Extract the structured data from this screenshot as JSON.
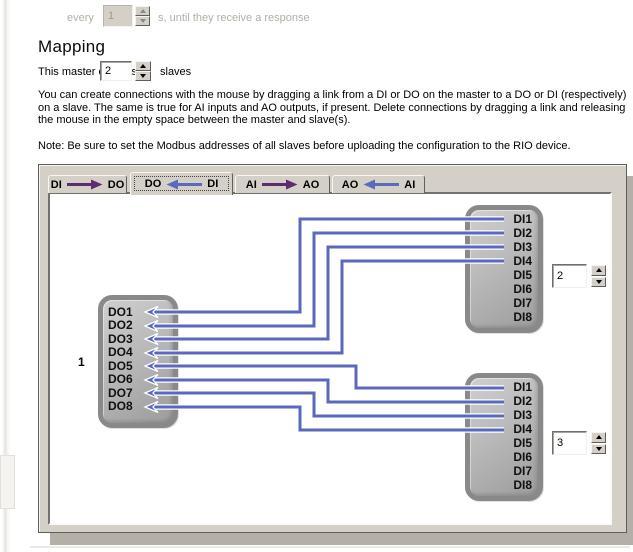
{
  "top_row": {
    "prefix": "every",
    "spin_value": "1",
    "suffix": "s, until they receive a response"
  },
  "heading": "Mapping",
  "master_controls": {
    "prefix": "This master controls",
    "spin_value": "2",
    "suffix": "slaves"
  },
  "paragraph": "You can create connections with the mouse by dragging a link from a DI or DO on the master to a DO or DI (respectively)\non a slave. The same is true for AI inputs and AO outputs, if present. Delete connections by dragging a link and releasing\nthe mouse in the empty space between the master and slave(s).",
  "note": "Note: Be sure to set the Modbus addresses of all slaves before uploading the configuration to the RIO device.",
  "tabs": [
    {
      "left": "DI",
      "right": "DO",
      "direction": "right",
      "arrow_color": "#5e2c6e",
      "selected": false
    },
    {
      "left": "DO",
      "right": "DI",
      "direction": "left",
      "arrow_color": "#5b6abd",
      "selected": true
    },
    {
      "left": "AI",
      "right": "AO",
      "direction": "right",
      "arrow_color": "#5e2c6e",
      "selected": false
    },
    {
      "left": "AO",
      "right": "AI",
      "direction": "left",
      "arrow_color": "#5b6abd",
      "selected": false
    }
  ],
  "diagram": {
    "wire_color": "#5a69bd",
    "master": {
      "id_label": "1",
      "pins": [
        "DO1",
        "DO2",
        "DO3",
        "DO4",
        "DO5",
        "DO6",
        "DO7",
        "DO8"
      ]
    },
    "slaves": [
      {
        "address": "2",
        "pins": [
          "DI1",
          "DI2",
          "DI3",
          "DI4",
          "DI5",
          "DI6",
          "DI7",
          "DI8"
        ]
      },
      {
        "address": "3",
        "pins": [
          "DI1",
          "DI2",
          "DI3",
          "DI4",
          "DI5",
          "DI6",
          "DI7",
          "DI8"
        ]
      }
    ],
    "connections": [
      {
        "master_pin": "DO1",
        "slave": 1,
        "slave_pin": "DI1"
      },
      {
        "master_pin": "DO2",
        "slave": 1,
        "slave_pin": "DI2"
      },
      {
        "master_pin": "DO3",
        "slave": 1,
        "slave_pin": "DI3"
      },
      {
        "master_pin": "DO4",
        "slave": 1,
        "slave_pin": "DI4"
      },
      {
        "master_pin": "DO5",
        "slave": 2,
        "slave_pin": "DI1"
      },
      {
        "master_pin": "DO6",
        "slave": 2,
        "slave_pin": "DI2"
      },
      {
        "master_pin": "DO7",
        "slave": 2,
        "slave_pin": "DI3"
      },
      {
        "master_pin": "DO8",
        "slave": 2,
        "slave_pin": "DI4"
      }
    ]
  }
}
